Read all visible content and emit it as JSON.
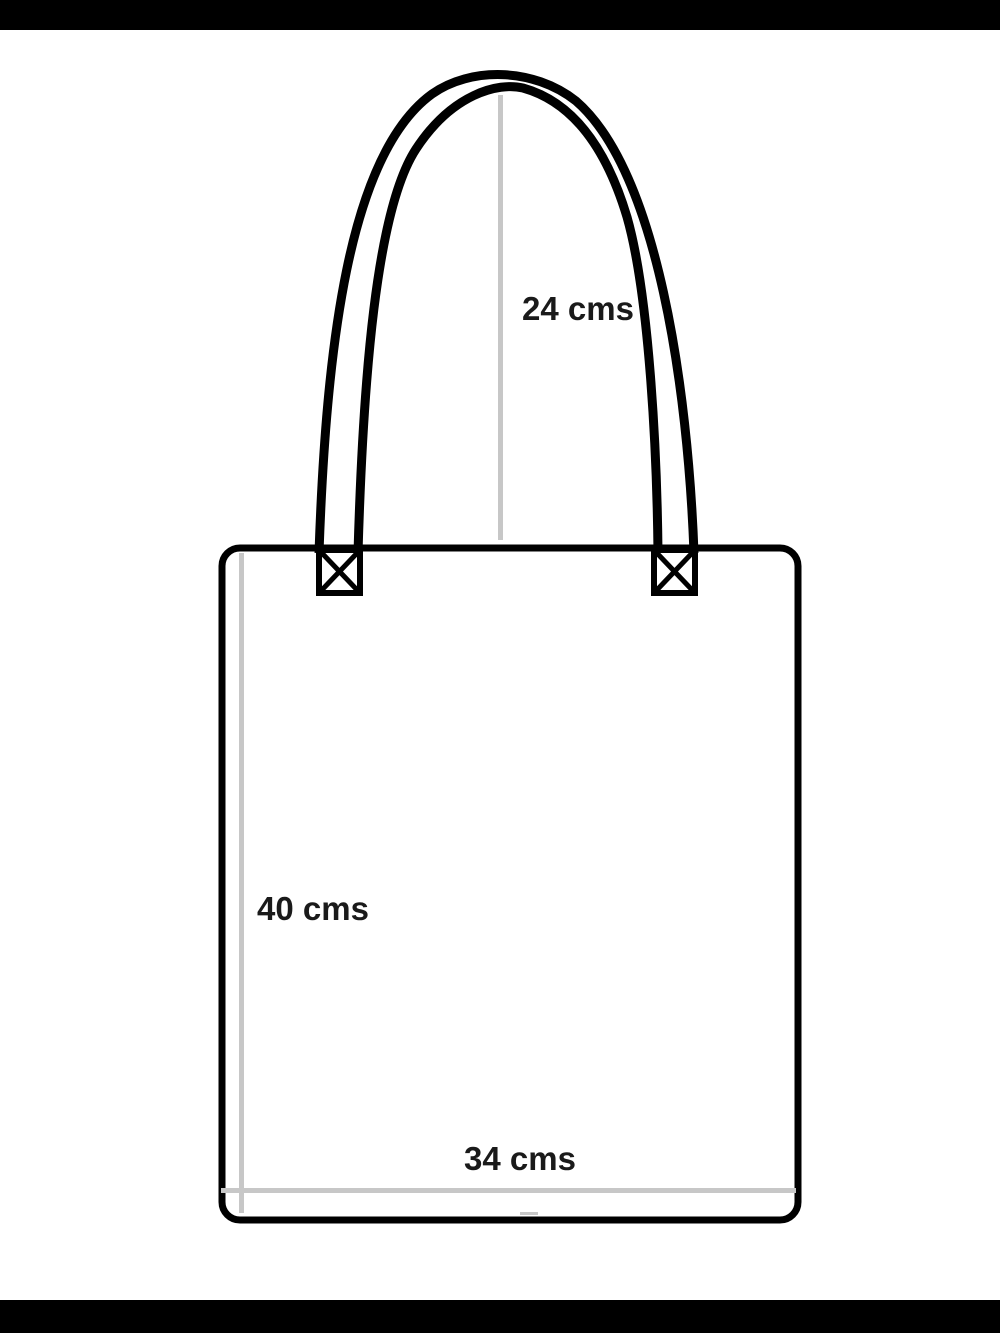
{
  "measurements": {
    "handle_height": {
      "label": "24 cms",
      "value": 24,
      "unit": "cms"
    },
    "bag_height": {
      "label": "40 cms",
      "value": 40,
      "unit": "cms"
    },
    "bag_width": {
      "label": "34 cms",
      "value": 34,
      "unit": "cms"
    }
  },
  "colors": {
    "outline": "#000000",
    "guide_line": "#c7c7c7",
    "label_text": "#1a1a1a",
    "background": "#ffffff",
    "letterbox_bar": "#000000"
  }
}
